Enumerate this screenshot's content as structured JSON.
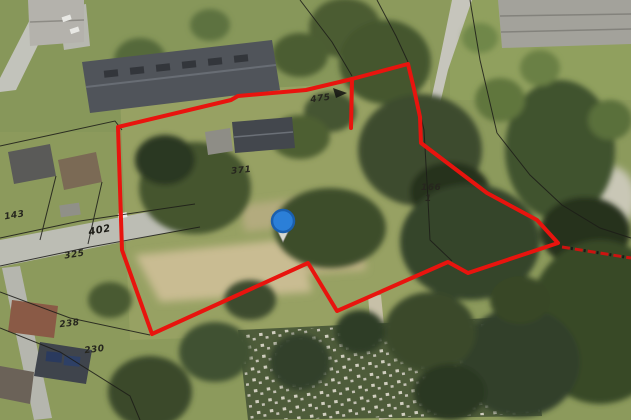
{
  "map": {
    "description": "aerial-cadastral-map-view",
    "boundary": {
      "color": "#e8140e",
      "points": "118,127 231,100 238,96 306,90 352,79 408,64 414,89 420,117 421,143 487,193 537,220 558,243 468,273 448,262 337,311 308,263 152,334 122,250",
      "spike_points": "352,79 351,128",
      "dashed_extension_points": "562,247 631,258"
    },
    "marker": {
      "name": "location-pin",
      "fill": "#2b7fd8",
      "stroke": "#1a5fae"
    },
    "parcel_labels": [
      {
        "text": "371"
      },
      {
        "text": "402"
      },
      {
        "text": "325"
      },
      {
        "text": "143"
      },
      {
        "text": "238"
      },
      {
        "text": "230"
      },
      {
        "text": "475"
      },
      {
        "text": "166"
      },
      {
        "text": "1"
      }
    ]
  }
}
